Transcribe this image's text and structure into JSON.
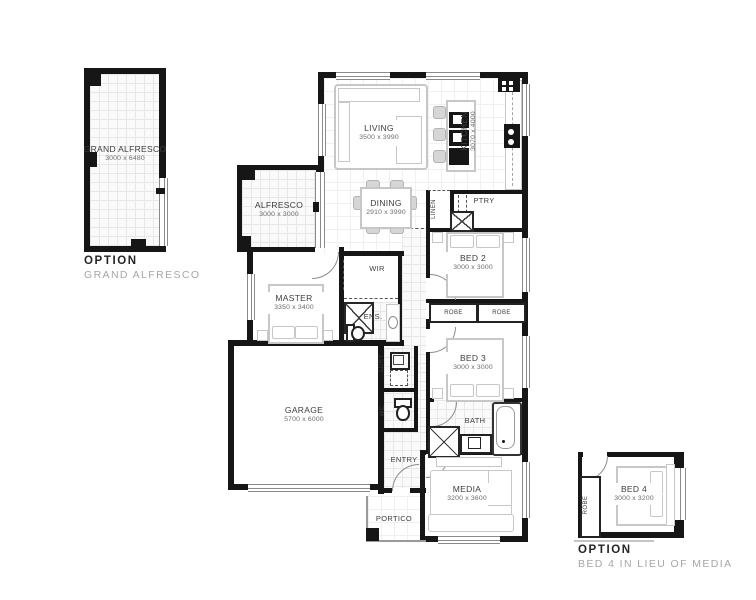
{
  "options": {
    "grand_alfresco": {
      "title": "OPTION",
      "subtitle": "GRAND ALFRESCO"
    },
    "bed4": {
      "title": "OPTION",
      "subtitle": "BED 4 IN LIEU OF MEDIA"
    }
  },
  "rooms": {
    "grand_alfresco": {
      "label": "GRAND ALFRESCO",
      "dims": "3000 x 6480"
    },
    "living": {
      "label": "LIVING",
      "dims": "3500 x 3990"
    },
    "kitchen": {
      "label": "KITCHEN",
      "dims": "3070 x 4000"
    },
    "dining": {
      "label": "DINING",
      "dims": "2910 x 3990"
    },
    "alfresco": {
      "label": "ALFRESCO",
      "dims": "3000 x 3000"
    },
    "ptry": {
      "label": "PTRY"
    },
    "linen": {
      "label": "LINEN"
    },
    "bed2": {
      "label": "BED 2",
      "dims": "3000 x 3000"
    },
    "wir": {
      "label": "WIR"
    },
    "master": {
      "label": "MASTER",
      "dims": "3350 x 3400"
    },
    "ens": {
      "label": "ENS."
    },
    "robe_a": {
      "label": "ROBE"
    },
    "robe_b": {
      "label": "ROBE"
    },
    "bed3": {
      "label": "BED 3",
      "dims": "3000 x 3000"
    },
    "garage": {
      "label": "GARAGE",
      "dims": "5700 x 6000"
    },
    "ldry": {
      "label": "LDRY"
    },
    "wc": {
      "label": "WC"
    },
    "bath": {
      "label": "BATH"
    },
    "entry": {
      "label": "ENTRY"
    },
    "media": {
      "label": "MEDIA",
      "dims": "3200 x 3600"
    },
    "portico": {
      "label": "PORTICO"
    },
    "bed4": {
      "label": "BED 4",
      "dims": "3000 x 3200"
    },
    "robe4": {
      "label": "ROBE"
    }
  },
  "colors": {
    "wall": "#161616",
    "tile_line": "#e7e7e7",
    "furniture": "#c7c7c7",
    "label_text": "#3d3d3d",
    "option_subtitle": "#a6a6a6"
  }
}
